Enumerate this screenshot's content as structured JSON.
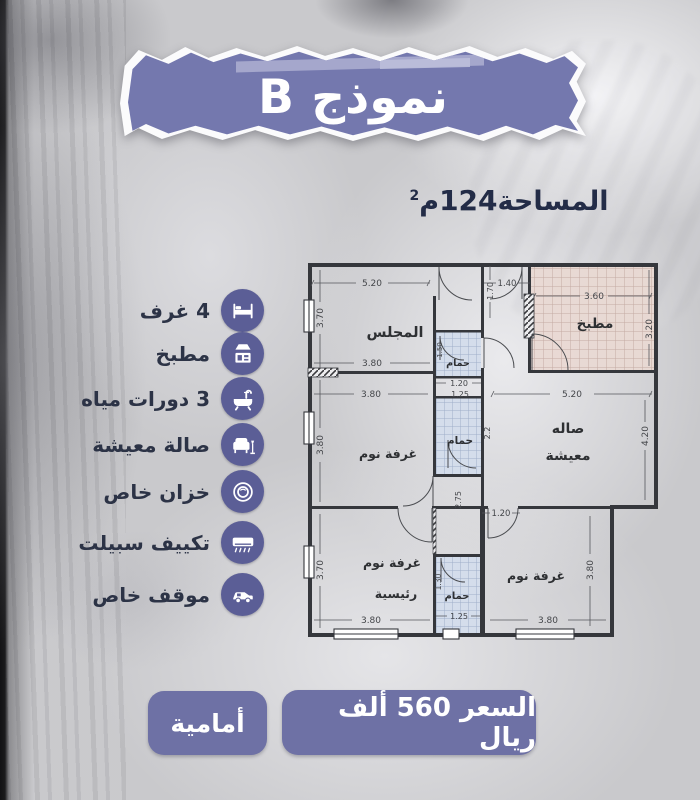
{
  "colors": {
    "banner_purple": "#7478ae",
    "button_purple": "#6e71a5",
    "icon_purple": "#5b5e96",
    "text_navy": "#232c47",
    "plan_ink": "#35373c"
  },
  "banner": {
    "title": "نموذج B"
  },
  "area": {
    "label": "المساحة",
    "value": "124",
    "unit": "م",
    "sup": "2"
  },
  "features": [
    {
      "icon": "bed-icon",
      "label": "4 غرف"
    },
    {
      "icon": "kitchen-icon",
      "label": "مطبخ"
    },
    {
      "icon": "bathtub-icon",
      "label": "3 دورات مياه"
    },
    {
      "icon": "sofa-icon",
      "label": "صالة معيشة"
    },
    {
      "icon": "tank-icon",
      "label": "خزان خاص"
    },
    {
      "icon": "ac-icon",
      "label": "تكييف سبيلت"
    },
    {
      "icon": "car-icon",
      "label": "موقف خاص"
    }
  ],
  "floorplan": {
    "rooms": {
      "majlis": "المجلس",
      "kitchen": "مطبخ",
      "bath_top": "حمام",
      "bath_mid": "حمام",
      "living_1": "صاله",
      "living_2": "معيشة",
      "bedroom_left": "غرفة نوم",
      "master_1": "غرفة نوم",
      "master_2": "رئيسية",
      "bath_bottom": "حمام",
      "bedroom_right": "غرفة نوم"
    },
    "dims": {
      "majlis_w": "5.20",
      "majlis_h": "3.70",
      "majlis_w2": "3.80",
      "entry_w": "1.40",
      "entry_h": "1.70",
      "kitchen_w": "3.60",
      "kitchen_h": "3.20",
      "bath_top_w": "1.20",
      "bath_top_h": "1.50",
      "bed_left_w": "3.80",
      "bed_left_h": "3.80",
      "bath_mid_w": "1.25",
      "bath_mid_h": "2.2",
      "living_w": "5.20",
      "living_h": "4.20",
      "hall_w": "1.20",
      "hall_h": "2.75",
      "master_w": "3.80",
      "master_h": "3.70",
      "bath_bot_w": "1.25",
      "bath_bot_h": "1.30",
      "bed_right_w": "3.80",
      "bed_right_h": "3.80"
    }
  },
  "footer": {
    "orientation_label": "أمامية",
    "price_label": "السعر 560 ألف ريال"
  }
}
